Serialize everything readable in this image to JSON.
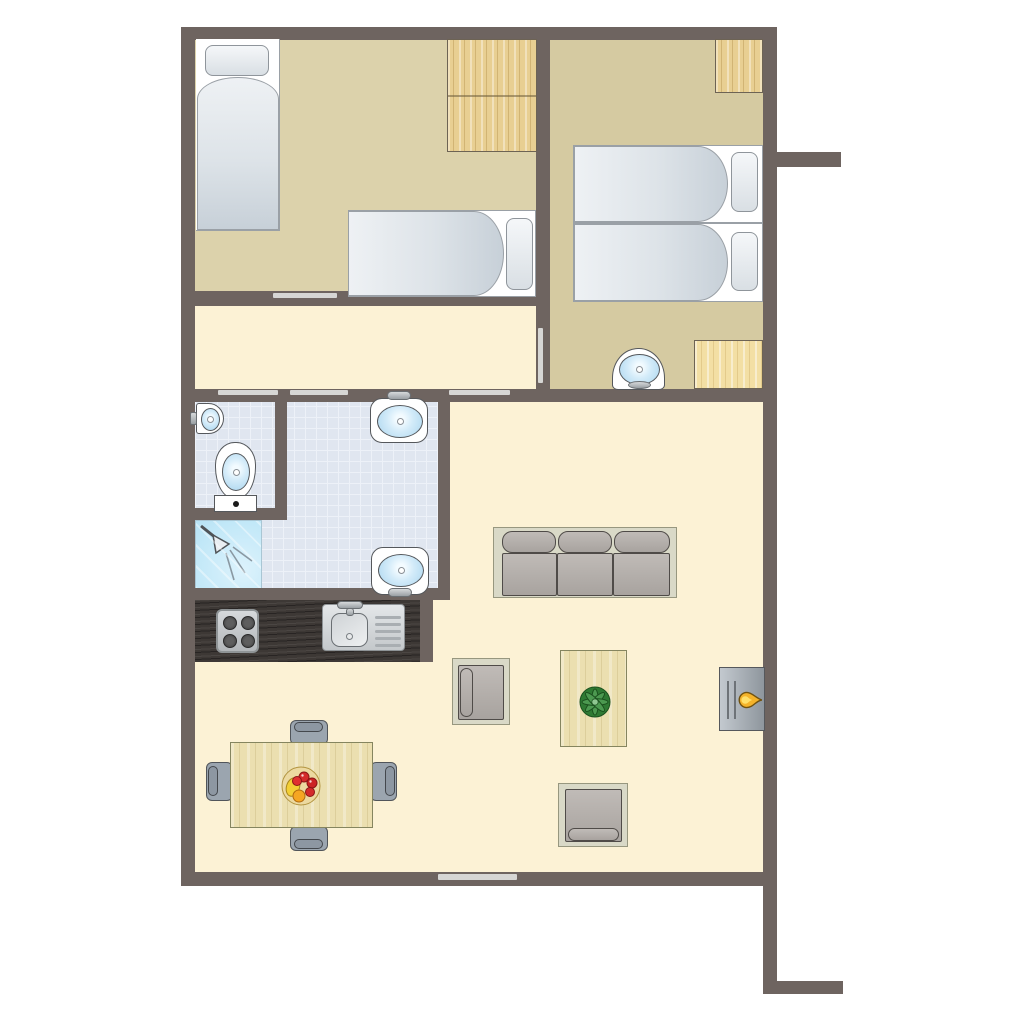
{
  "meta": {
    "title": "Apartment floor plan, top-down architectural view"
  },
  "palette": {
    "wall": "#6e6460",
    "living_floor": "#fcf2d5",
    "bedroom1_floor": "#dcd2ab",
    "bedroom2_floor": "#d5caa1",
    "bathroom_tile": "#e0e6f0",
    "shower_blue": "#c2e8f8",
    "wood_cabinet": "#e8cf92",
    "kitchen_counter": "#3d3835",
    "upholstery_gray": "#9ba5af",
    "basin_blue": "#abd6ef",
    "flame_orange": "#f4b32a",
    "plant_green": "#3c8a40",
    "opening_light": "#d6d6d4"
  },
  "fixtures": [
    "single-bed",
    "single-bed",
    "double-bed",
    "wardrobe",
    "wardrobe",
    "wardrobe",
    "vanity-sink",
    "corner-sink",
    "toilet",
    "shower",
    "bathroom-sink",
    "bathroom-sink",
    "stove-4-burner",
    "kitchen-sink-with-drainer",
    "sofa-3-seat",
    "armchair",
    "armchair",
    "coffee-table-with-plant",
    "fireplace-stove",
    "dining-table-with-fruit-bowl",
    "dining-chair",
    "dining-chair",
    "dining-chair",
    "dining-chair"
  ],
  "openings": [
    "door-bedroom1",
    "door-wc",
    "door-bathroom",
    "door-living-room",
    "door-bedroom2",
    "window-south"
  ]
}
